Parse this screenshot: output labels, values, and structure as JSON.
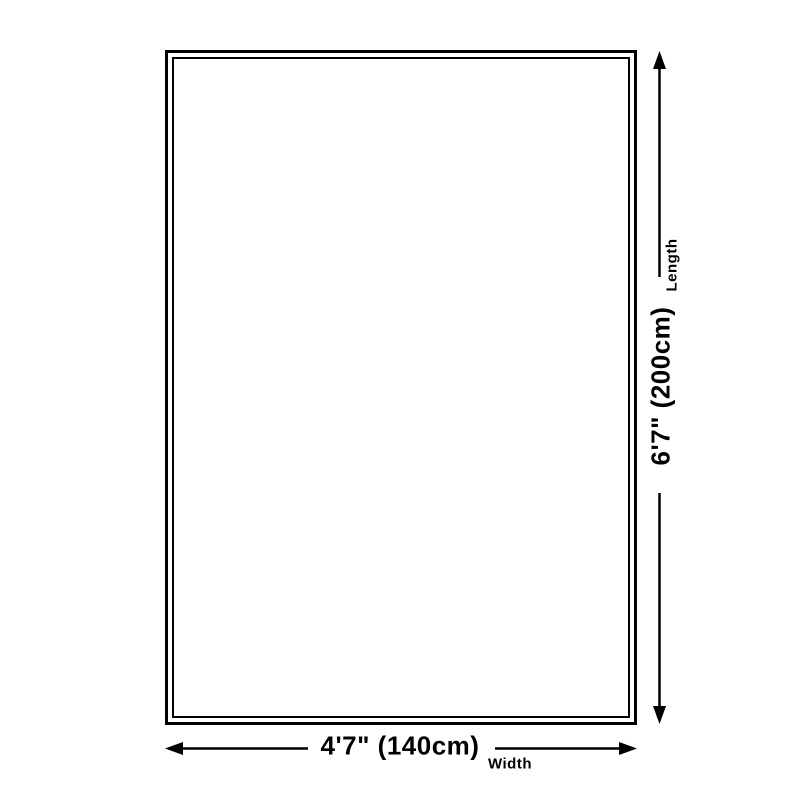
{
  "colors": {
    "background": "#ffffff",
    "ink": "#000000"
  },
  "diagram": {
    "length": {
      "value": "6'7\" (200cm)",
      "label": "Length"
    },
    "width": {
      "value": "4'7\" (140cm)",
      "label": "Width"
    }
  }
}
